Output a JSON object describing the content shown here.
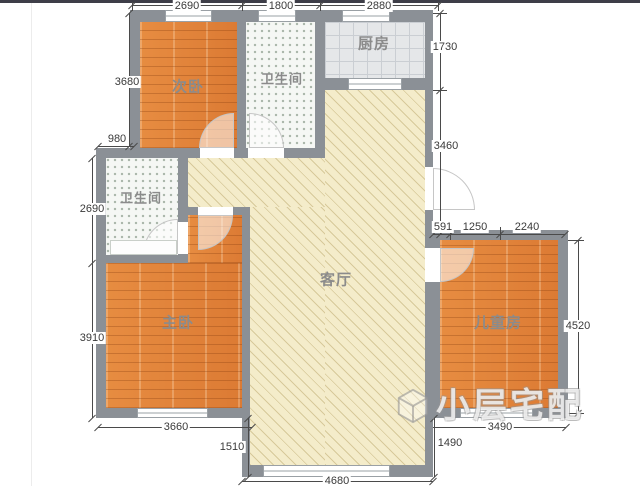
{
  "rooms": {
    "second_bedroom": "次卧",
    "bath_top": "卫生间",
    "kitchen": "厨房",
    "living": "客厅",
    "bath_left": "卫生间",
    "master_bedroom": "主卧",
    "kids_room": "儿童房"
  },
  "dims": {
    "top_a": "2690",
    "top_b": "1800",
    "top_c": "2880",
    "left_a": "3680",
    "left_b": "980",
    "left_c": "2690",
    "left_d": "3910",
    "right_a": "1730",
    "right_b": "3460",
    "right_c": "4520",
    "kids_a": "591",
    "kids_b": "1250",
    "kids_c": "2240",
    "bottom_a": "3660",
    "bottom_b": "1510",
    "bottom_c": "4680",
    "bottom_d": "1490",
    "bottom_e": "3490"
  },
  "watermark": {
    "text": "小层宅配"
  },
  "colors": {
    "wall": "#8b9096",
    "wood_floor": "#e0813a",
    "living_floor": "#f4ecca",
    "bath_floor": "#f5f7f4",
    "kitchen_floor": "#e5e7e9",
    "dimension_text": "#3a3a3a"
  }
}
